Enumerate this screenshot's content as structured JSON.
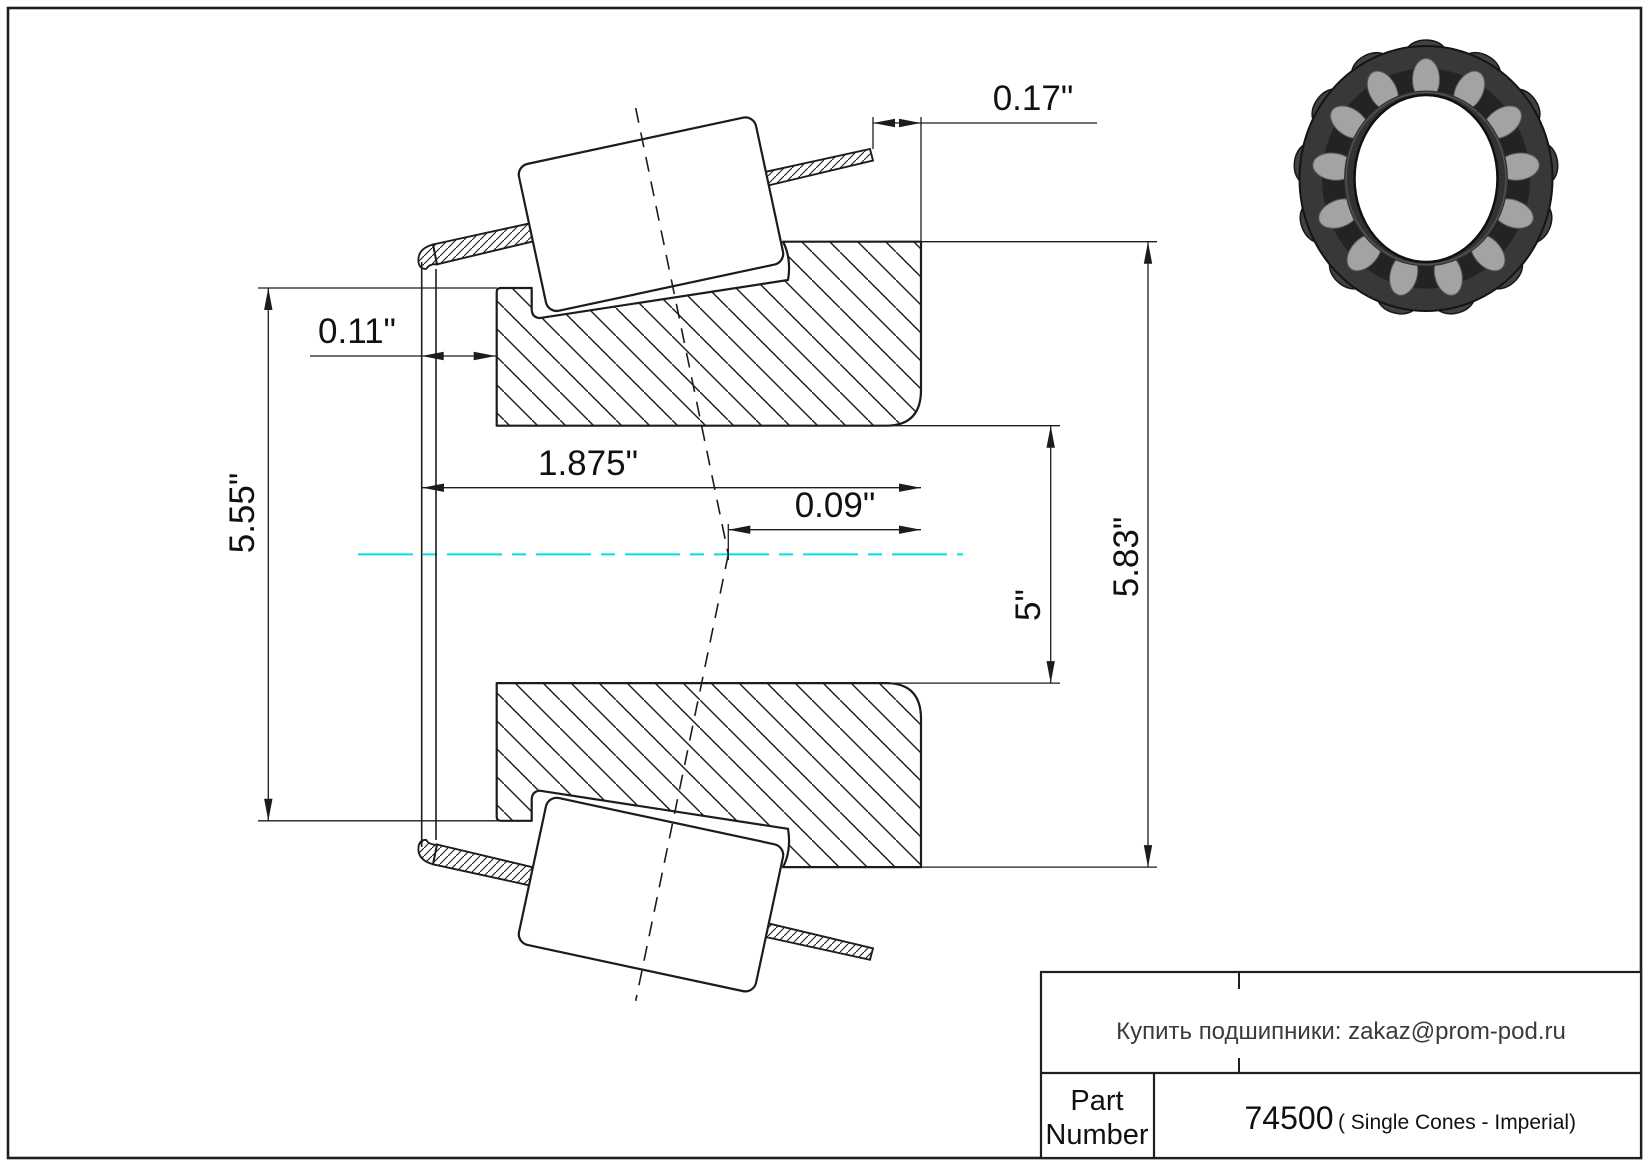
{
  "page": {
    "background": "#ffffff",
    "border_color": "#1f1f1f"
  },
  "drawing": {
    "line_color": "#1c1c1c",
    "centerline_color": "#00e0e0",
    "dim_labels": {
      "back_standout": "0.17\"",
      "front_standout": "0.11\"",
      "width": "1.875\"",
      "effective_center": "0.09\"",
      "front_outer_diameter": "5.55\"",
      "bore_diameter": "5\"",
      "back_outer_diameter": "5.83\""
    }
  },
  "title_block": {
    "contact": "Купить подшипники: zakaz@prom-pod.ru",
    "part_label_line1": "Part",
    "part_label_line2": "Number",
    "part_number": "74500",
    "part_series": "( Single Cones - Imperial)"
  }
}
